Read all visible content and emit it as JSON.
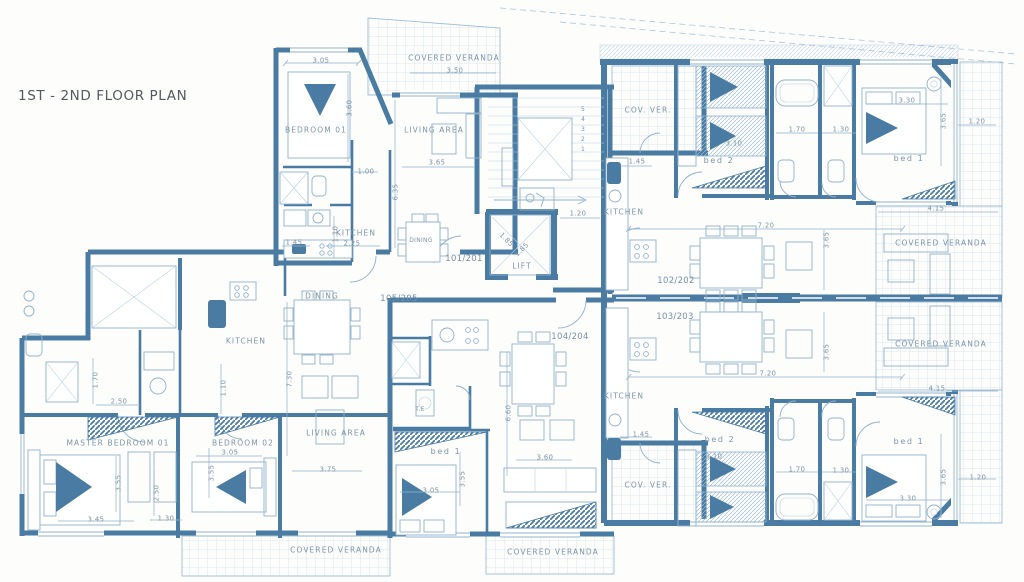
{
  "title": "1ST - 2ND FLOOR PLAN",
  "colors": {
    "wall": "#4a7ba3",
    "thin_line": "#8fb2cd",
    "grid_line": "#c9dcea",
    "label_text": "#7b95aa",
    "title_text": "#54595e",
    "background": "#fdfdfc"
  },
  "core": {
    "lift_label": "LIFT",
    "lift_dim_a": "1.85",
    "lift_dim_b": "1.85",
    "lobby_dim": "1.20",
    "stair_steps": [
      "5",
      "4",
      "3",
      "2",
      "1"
    ]
  },
  "apt_101": {
    "number": "101/201",
    "veranda": "COVERED VERANDA",
    "veranda_dim": "3.50",
    "bedroom": "BEDROOM 01",
    "bedroom_w": "3.05",
    "bedroom_h": "3.60",
    "living": "LIVING AREA",
    "living_w": "3.65",
    "living_h": "6.35",
    "hall_dim": "1.00",
    "kitchen": "KITCHEN",
    "kitchen_w": "2.25",
    "kitchen_h": "1.10",
    "kitchen_d": "1.45",
    "dining": "DINING"
  },
  "apt_102": {
    "number": "102/202",
    "cov_ver": "COV. VER.",
    "kitchen": "KITCHEN",
    "kitchen_dim": "1.45",
    "bed2": "bed 2",
    "bed2_dim": "3.10",
    "bath_dim_a": "1.70",
    "bath_dim_b": "1.30",
    "bed1": "bed 1",
    "bed1_w": "3.30",
    "bed1_h": "3.65",
    "balcony_dim": "1.20",
    "living_w": "7.20",
    "living_h": "3.65",
    "veranda": "COVERED VERANDA",
    "veranda_w": "4.15"
  },
  "apt_103": {
    "number": "103/203",
    "cov_ver": "COV. VER.",
    "kitchen": "KITCHEN",
    "kitchen_dim": "1.45",
    "bed2": "bed 2",
    "bed2_dim": "3.10",
    "bath_dim_a": "1.70",
    "bath_dim_b": "1.30",
    "bed1": "bed 1",
    "bed1_w": "3.30",
    "bed1_h": "3.65",
    "balcony_dim": "1.20",
    "living_w": "7.20",
    "living_h": "3.65",
    "veranda": "COVERED VERANDA",
    "veranda_w": "4.15"
  },
  "apt_104": {
    "number": "104/204",
    "te": "T.E",
    "bed1": "bed 1",
    "bed1_w": "3.05",
    "bed1_h": "3.55",
    "living_h": "6.60",
    "unit_w": "3.60",
    "veranda": "COVERED VERANDA"
  },
  "apt_105": {
    "number": "105/205",
    "kitchen": "KITCHEN",
    "dining": "DINING",
    "living": "LIVING AREA",
    "living_w": "3.75",
    "living_h": "7.30",
    "hall_w": "2.50",
    "hall_h": "1.70",
    "pantry_dim": "1.10",
    "master": "MASTER BEDROOM 01",
    "master_w": "3.45",
    "master_h": "3.55",
    "corridor_dim": "2.50",
    "wc_dim": "1.30",
    "bedroom02": "BEDROOM 02",
    "bedroom02_w": "3.05",
    "bedroom02_h": "3.55",
    "veranda": "COVERED VERANDA"
  }
}
